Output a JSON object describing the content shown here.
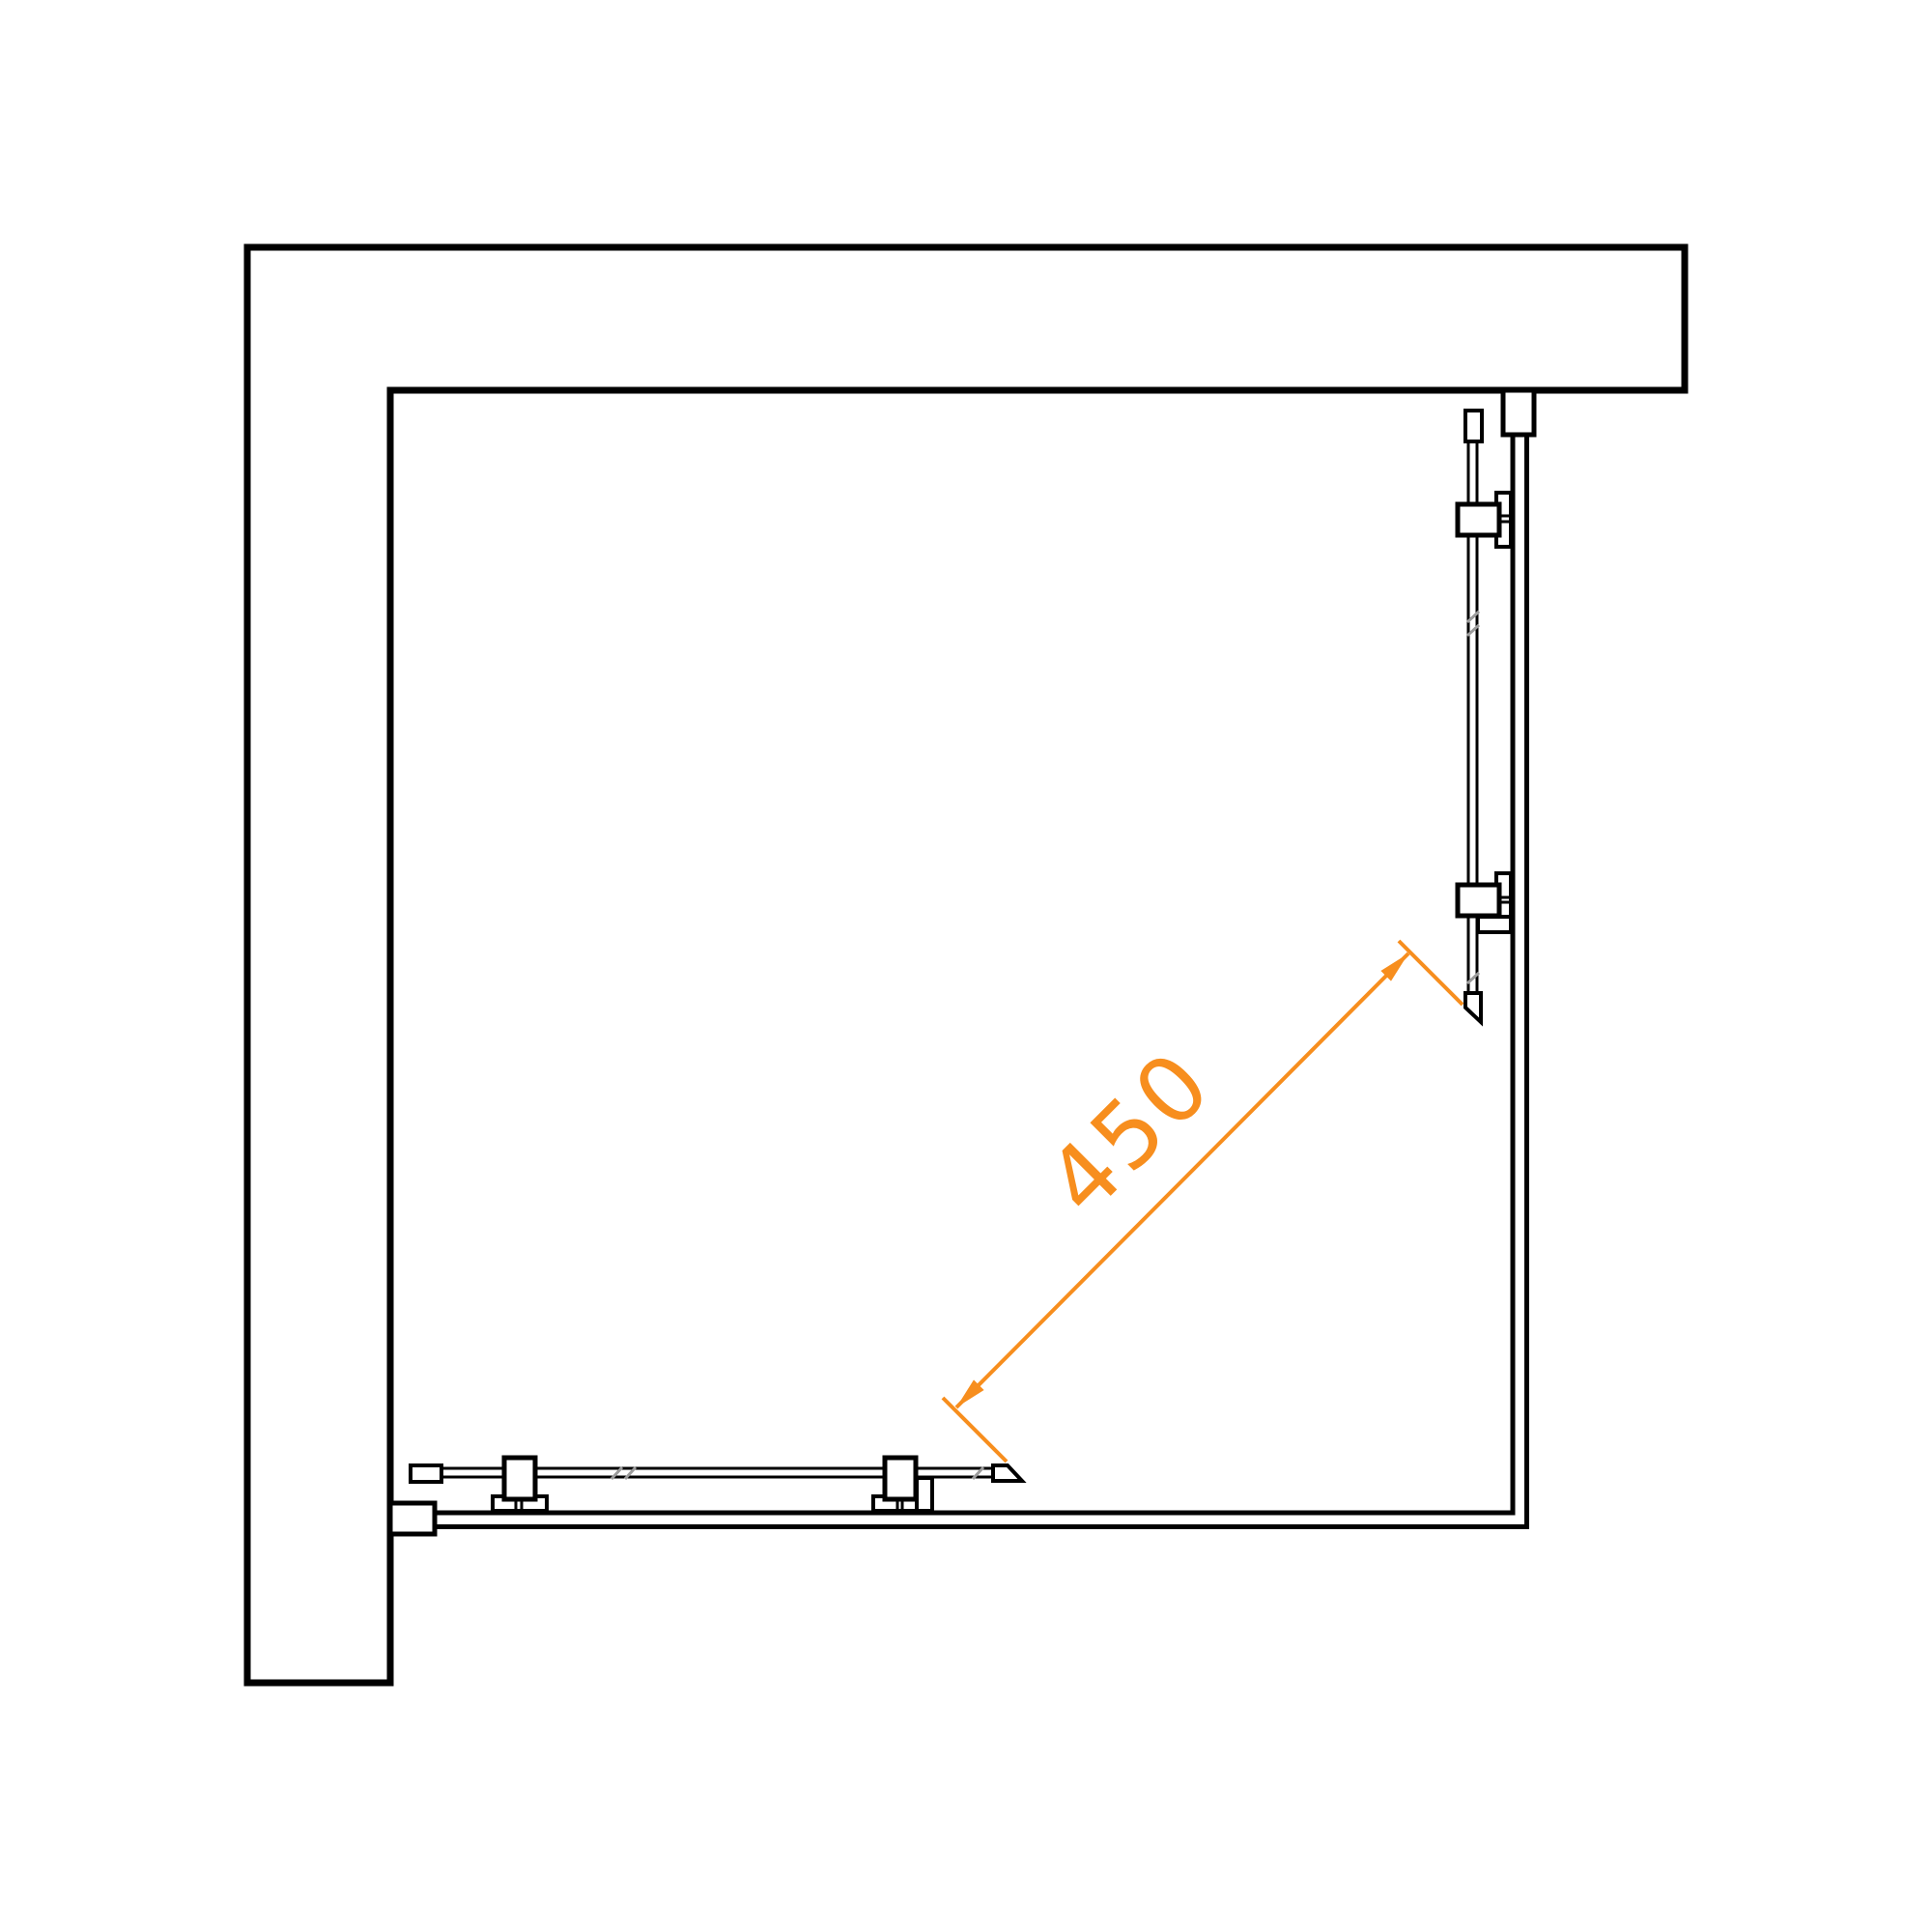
{
  "drawing": {
    "background_color": "#FFFFFF",
    "line_color": "#000000",
    "glass_hatch_color": "#9B9B9B"
  },
  "dimension": {
    "label": "450",
    "color": "#F78E1E"
  }
}
